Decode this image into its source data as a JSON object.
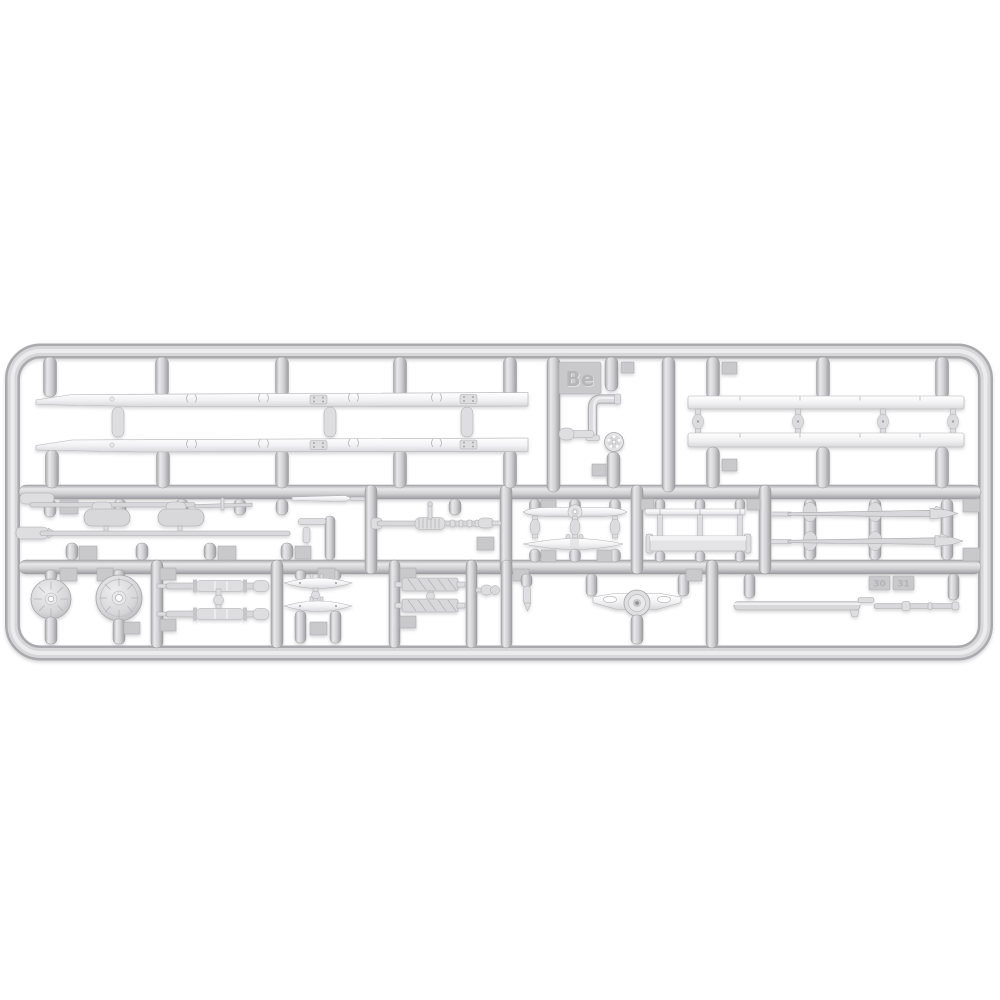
{
  "scene": {
    "type": "photo of an injection-molded model-kit sprue on a white background",
    "background_color": "#ffffff"
  },
  "sprue": {
    "letter": "Be",
    "plastic": "light grey styrene",
    "tab_numbers": {
      "tab_30": "30",
      "tab_31": "31"
    },
    "contents": {
      "top_left": "two long truck chassis frame rails",
      "top_middle": "exhaust elbow pipe and small pulley wheel, sprue letter tab Be",
      "top_right": "two long flat side strips joined by round links",
      "middle_left": "thin tie rods and twin-chamber muffler tanks",
      "middle_center_left": "fan blade and elliptical leaf spring",
      "middle_center_right": "thin flat strip and rectangular cross box",
      "middle_right": "two tapered steering rods with arrow tips",
      "bottom_left": "two round differential / hub housings",
      "bottom_axles": "two axle shafts joined by a ball link",
      "bottom_springs": "two leaf springs",
      "bottom_bars": "two ribbed frame cross bars",
      "bottom_valve": "small valve stub",
      "bottom_bracket": "winged engine-mount bracket with round boss",
      "bottom_right": "long barrel-shaped drive shaft"
    }
  },
  "colors": {
    "background": "#ffffff",
    "runner": "#cfcfd2",
    "runner_highlight": "#e9e9eb",
    "runner_shadow": "#a2a2a6",
    "part": "#f1f1f3",
    "part_shadow": "#c4c4c8",
    "tab": "#c9c9cc",
    "emboss": "#b6b6b9"
  }
}
